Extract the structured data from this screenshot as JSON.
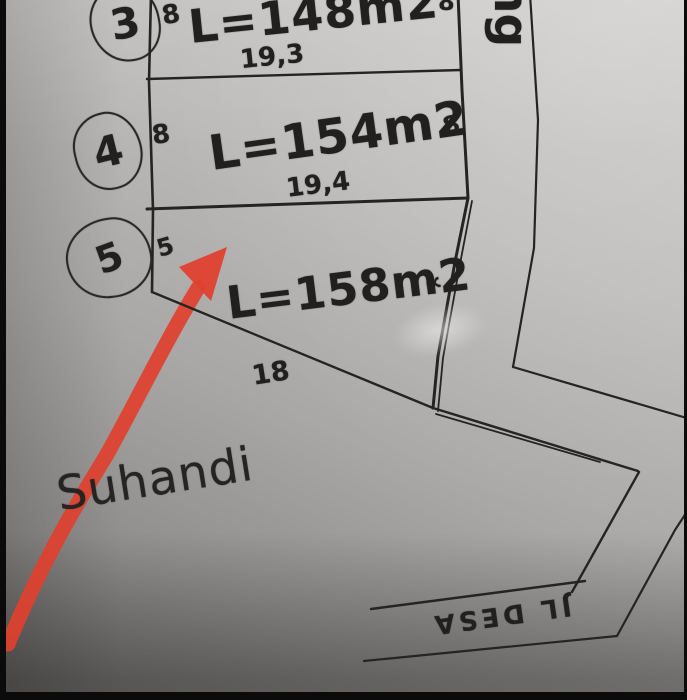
{
  "colors": {
    "arrow_red": "#e0402e",
    "ink": "#242220",
    "paper_light": "#cdcbc9",
    "paper_dark": "#747270"
  },
  "plots": [
    {
      "circle": "3",
      "left_dim": "8",
      "area": "L=148m2",
      "width_dim": "19,3",
      "right_dim": "8"
    },
    {
      "circle": "4",
      "left_dim": "8",
      "area": "L=154m2",
      "width_dim": "19,4",
      "right_dim": "8"
    },
    {
      "circle": "5",
      "left_dim": "5",
      "area": "L=158m2",
      "bottom_dim": "18",
      "scribble": "∝"
    }
  ],
  "owner": {
    "name": "Suhandi"
  },
  "roads": {
    "vertical_street_fragment": "ng",
    "bottom_street": "JL DESA"
  }
}
